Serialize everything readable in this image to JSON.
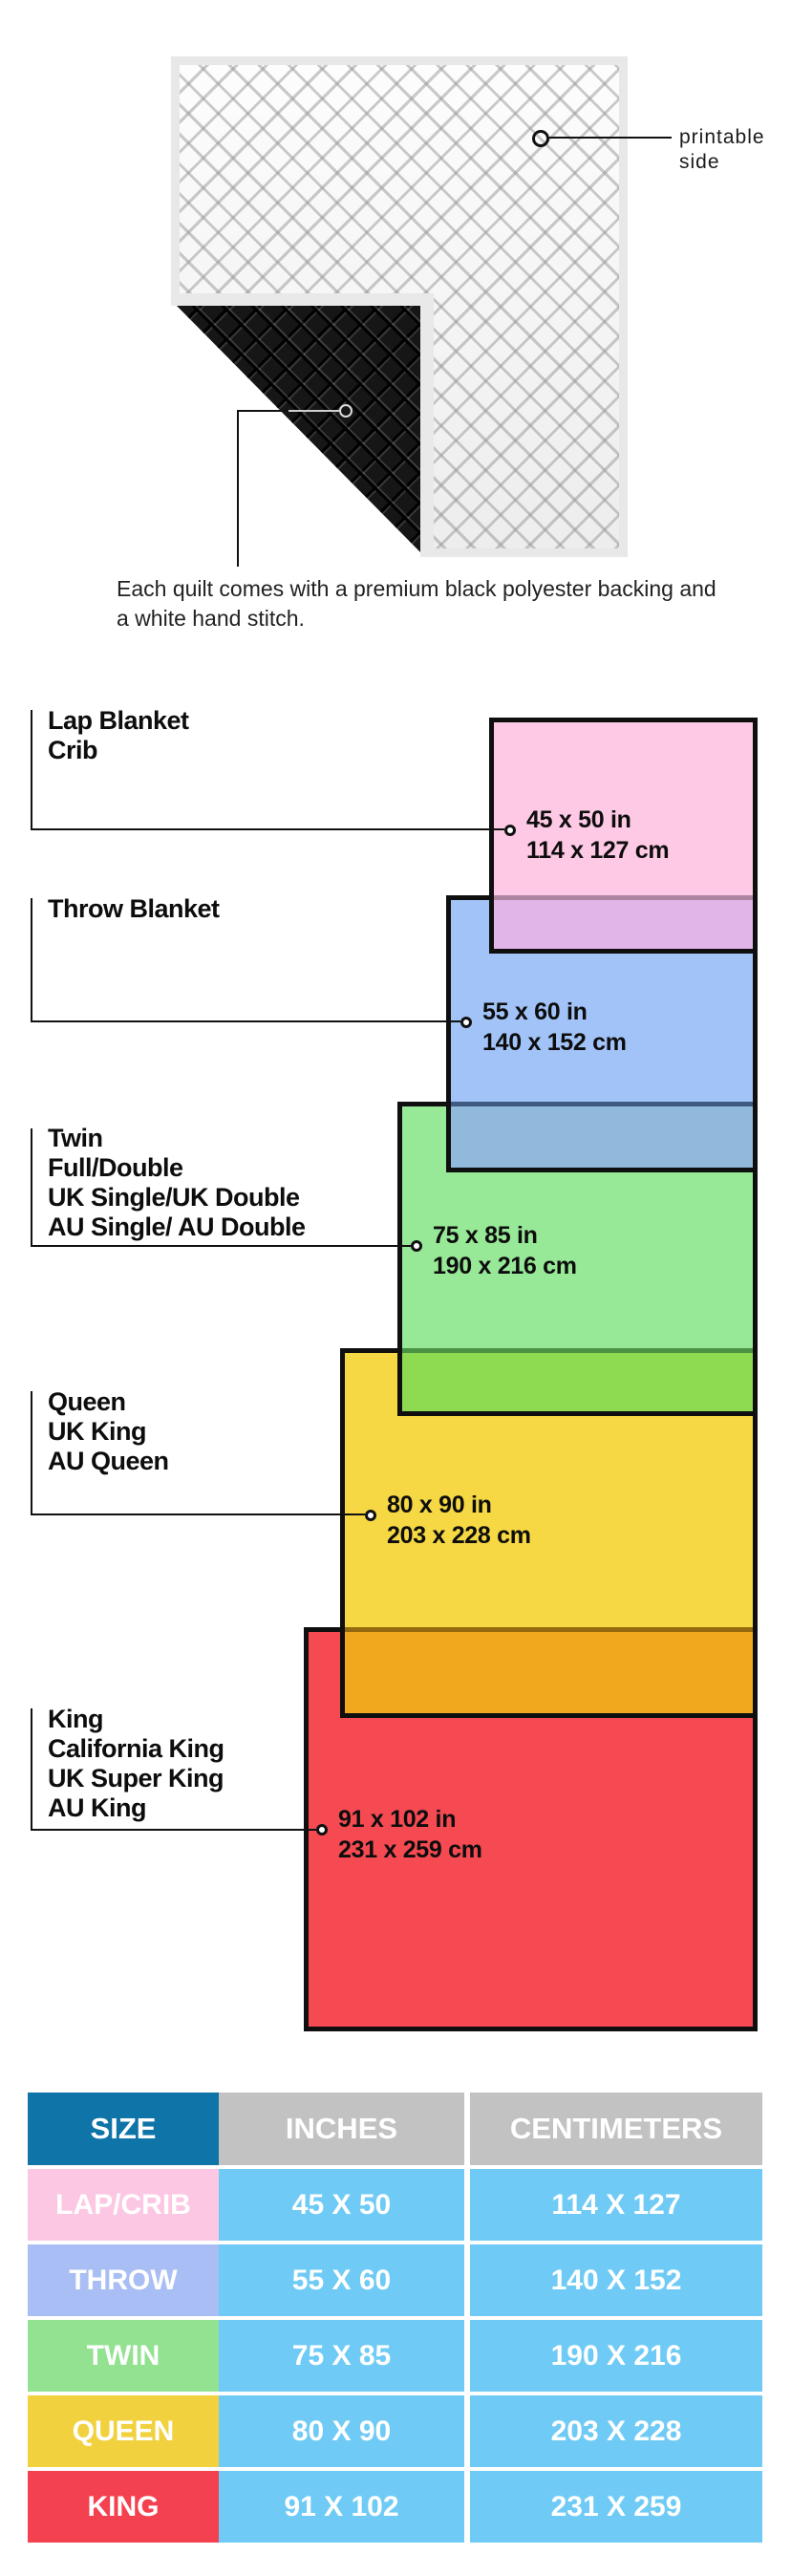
{
  "quilt_section": {
    "printable_callout": "printable side",
    "caption": "Each quilt comes with a premium black polyester backing and a white hand stitch."
  },
  "diagram": {
    "groups": [
      {
        "names": [
          "Lap Blanket",
          "Crib"
        ],
        "inches": "45 x 50 in",
        "cm": "114 x 127 cm",
        "fill": "#fec9e4"
      },
      {
        "names": [
          "Throw Blanket"
        ],
        "inches": "55 x 60 in",
        "cm": "140 x 152 cm",
        "fill": "#a2c3f8"
      },
      {
        "names": [
          "Twin",
          "Full/Double",
          "UK Single/UK Double",
          "AU Single/ AU Double"
        ],
        "inches": "75 x 85 in",
        "cm": "190 x 216 cm",
        "fill": "#97e897"
      },
      {
        "names": [
          "Queen",
          "UK King",
          "AU Queen"
        ],
        "inches": "80 x 90 in",
        "cm": "203 x 228 cm",
        "fill": "#f5d843"
      },
      {
        "names": [
          "King",
          "California King",
          "UK Super King",
          "AU King"
        ],
        "inches": "91 x 102 in",
        "cm": "231 x 259 cm",
        "fill": "#f54a52"
      }
    ],
    "overlaps": [
      {
        "fill": "#e1b5e7"
      },
      {
        "fill": "#90b9dc"
      },
      {
        "fill": "#8edb51"
      },
      {
        "fill": "#f1a71e"
      }
    ]
  },
  "table": {
    "headers": [
      {
        "label": "SIZE",
        "fill": "#0f74a8"
      },
      {
        "label": "INCHES",
        "fill": "#c2c2c2"
      },
      {
        "label": "CENTIMETERS",
        "fill": "#c2c2c2"
      }
    ],
    "value_fill": "#6fcbf5",
    "rows": [
      {
        "size": "LAP/CRIB",
        "inches": "45 X 50",
        "cm": "114 X 127",
        "fill": "#fcc7e2"
      },
      {
        "size": "THROW",
        "inches": "55 X 60",
        "cm": "140 X 152",
        "fill": "#a9bef4"
      },
      {
        "size": "TWIN",
        "inches": "75 X 85",
        "cm": "190 X 216",
        "fill": "#92e292"
      },
      {
        "size": "QUEEN",
        "inches": "80 X 90",
        "cm": "203 X 228",
        "fill": "#f2d13e"
      },
      {
        "size": "KING",
        "inches": "91 X 102",
        "cm": "231 X 259",
        "fill": "#f4414f"
      }
    ]
  }
}
